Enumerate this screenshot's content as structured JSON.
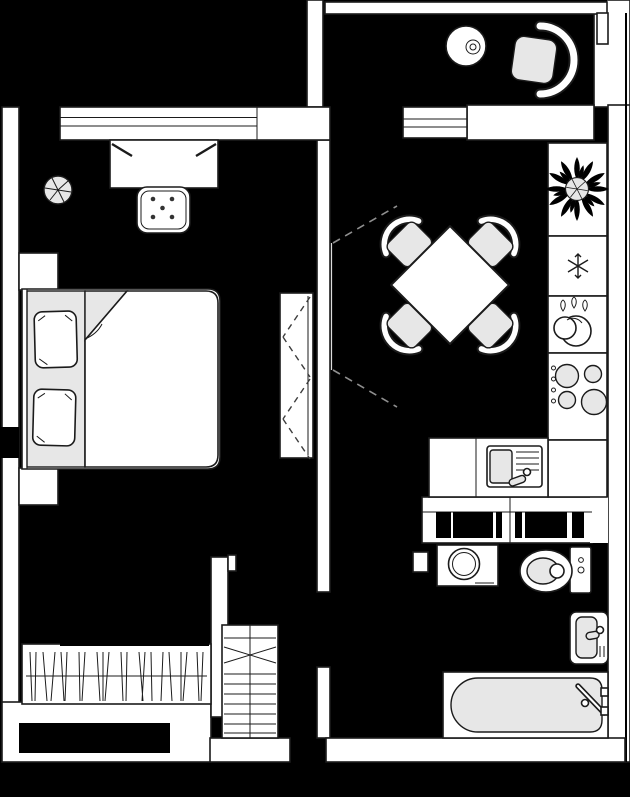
{
  "title": "one-bedroom-apartment-floor-plan",
  "colors": {
    "floor": "#000000",
    "wall": "#ffffff",
    "line": "#1b1b1b",
    "gray": "#e7e7e7",
    "dash": "#8f8f8f"
  },
  "rooms": {
    "bedroom": {
      "fixtures": [
        "plant",
        "desk",
        "stool",
        "double-bed",
        "pillow-left",
        "pillow-right",
        "nightstand-top",
        "nightstand-bottom",
        "wardrobe",
        "built-in-closet"
      ],
      "windows": [
        "bedroom-window"
      ],
      "stool_dots": 5,
      "pillows": 2
    },
    "kitchen": {
      "fixtures": [
        "dining-table",
        "chair-nw",
        "chair-ne",
        "chair-sw",
        "chair-se",
        "plant",
        "refrigerator",
        "dish-drainer",
        "stove",
        "counter",
        "kitchen-sink"
      ],
      "chairs": 4,
      "stove_burners": 4,
      "stove_knobs": 4,
      "drainer_drops": 3
    },
    "balcony": {
      "fixtures": [
        "round-table",
        "armchair"
      ]
    },
    "bathroom": {
      "fixtures": [
        "washing-machine",
        "toilet",
        "wash-basin",
        "bathtub"
      ]
    },
    "hallway": {
      "fixtures": [
        "staircase",
        "vent-shaft"
      ]
    }
  },
  "symbols": {
    "snowflake": "refrigerator",
    "hatched-rect": "closet-with-hangers",
    "dashed-lines": "door-swing / wardrobe front",
    "ladder": "staircase"
  }
}
